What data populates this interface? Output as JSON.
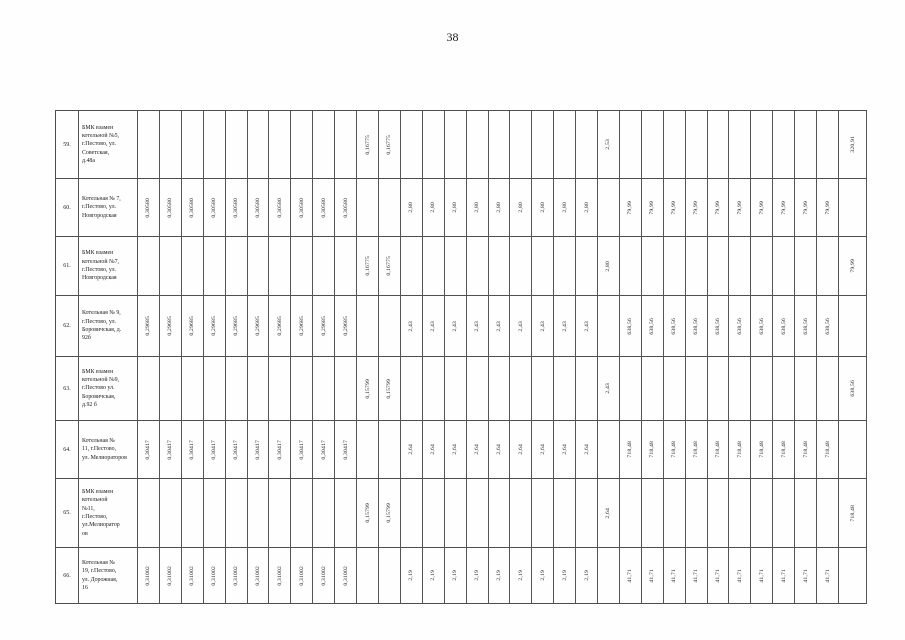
{
  "page": {
    "number": "38"
  },
  "table": {
    "num_data_columns": 33,
    "rows": [
      {
        "num": "59.",
        "name": "БМК взамен котельной №5, г.Пестово, ул. Советская, д.48а",
        "name_lines": [
          "БМК взамен",
          "котельной №5,",
          "г.Пестово, ул.",
          "Советская,",
          "д.48а"
        ],
        "values": [
          "",
          "",
          "",
          "",
          "",
          "",
          "",
          "",
          "",
          "",
          "0,16775",
          "0,16775",
          "",
          "",
          "",
          "",
          "",
          "",
          "",
          "",
          "",
          "2,53",
          "",
          "",
          "",
          "",
          "",
          "",
          "",
          "",
          "",
          "",
          "320,91"
        ]
      },
      {
        "num": "60.",
        "name": "Котельная № 7, г.Пестово, ул. Новгородская",
        "name_lines": [
          "Котельная № 7,",
          "г.Пестово, ул.",
          "Новгородская"
        ],
        "values": [
          "0,30580",
          "0,30580",
          "0,30580",
          "0,30580",
          "0,30580",
          "0,30580",
          "0,30580",
          "0,30580",
          "0,30580",
          "0,30580",
          "",
          "",
          "2,80",
          "2,80",
          "2,80",
          "2,80",
          "2,80",
          "2,80",
          "2,80",
          "2,80",
          "2,80",
          "",
          "79,99",
          "79,99",
          "79,99",
          "79,99",
          "79,99",
          "79,99",
          "79,99",
          "79,99",
          "79,99",
          "79,99",
          ""
        ]
      },
      {
        "num": "61.",
        "name": "БМК взамен котельной №7, г.Пестово, ул. Новгородская",
        "name_lines": [
          "БМК взамен",
          "котельной №7,",
          "г.Пестово, ул.",
          "Новгородская"
        ],
        "values": [
          "",
          "",
          "",
          "",
          "",
          "",
          "",
          "",
          "",
          "",
          "0,16775",
          "0,16775",
          "",
          "",
          "",
          "",
          "",
          "",
          "",
          "",
          "",
          "2,80",
          "",
          "",
          "",
          "",
          "",
          "",
          "",
          "",
          "",
          "",
          "79,99"
        ]
      },
      {
        "num": "62.",
        "name": "Котельная № 9, г.Пестово, ул. Боровичская, д. 92б",
        "name_lines": [
          "Котельная № 9,",
          "г.Пестово, ул.",
          "Боровичская, д.",
          "92б"
        ],
        "values": [
          "0,29685",
          "0,29685",
          "0,29685",
          "0,29685",
          "0,29685",
          "0,29685",
          "0,29685",
          "0,29685",
          "0,29685",
          "0,29685",
          "",
          "",
          "2,43",
          "2,43",
          "2,43",
          "2,43",
          "2,43",
          "2,43",
          "2,43",
          "2,43",
          "2,43",
          "",
          "638,56",
          "638,56",
          "638,56",
          "638,56",
          "638,56",
          "638,56",
          "638,56",
          "638,56",
          "638,56",
          "638,56",
          ""
        ]
      },
      {
        "num": "63.",
        "name": "БМК взамен котельной №9, г.Пестово ул. Боровичская, д.92 б",
        "name_lines": [
          "БМК взамен",
          "котельной №9,",
          "г.Пестово ул.",
          "Боровичская,",
          "д.92 б"
        ],
        "values": [
          "",
          "",
          "",
          "",
          "",
          "",
          "",
          "",
          "",
          "",
          "0,15799",
          "0,15799",
          "",
          "",
          "",
          "",
          "",
          "",
          "",
          "",
          "",
          "2,43",
          "",
          "",
          "",
          "",
          "",
          "",
          "",
          "",
          "",
          "",
          "638,56"
        ]
      },
      {
        "num": "64.",
        "name": "Котельная № 11, г.Пестово, ул. Мелиораторов",
        "name_lines": [
          "Котельная №",
          "11, г.Пестово,",
          "ул. Мелиораторов"
        ],
        "values": [
          "0,30417",
          "0,30417",
          "0,30417",
          "0,30417",
          "0,30417",
          "0,30417",
          "0,30417",
          "0,30417",
          "0,30417",
          "0,30417",
          "",
          "",
          "2,64",
          "2,64",
          "2,64",
          "2,64",
          "2,64",
          "2,64",
          "2,64",
          "2,64",
          "2,64",
          "",
          "718,48",
          "718,48",
          "718,48",
          "718,48",
          "718,48",
          "718,48",
          "718,48",
          "718,48",
          "718,48",
          "718,48",
          ""
        ]
      },
      {
        "num": "65.",
        "name": "БМК взамен котельной №11, г.Пестово, ул.Мелиораторов",
        "name_lines": [
          "БМК взамен",
          "котельной",
          "№11,",
          "г.Пестово,",
          "ул.Мелиоратор",
          "ов"
        ],
        "values": [
          "",
          "",
          "",
          "",
          "",
          "",
          "",
          "",
          "",
          "",
          "0,15799",
          "0,15799",
          "",
          "",
          "",
          "",
          "",
          "",
          "",
          "",
          "",
          "2,64",
          "",
          "",
          "",
          "",
          "",
          "",
          "",
          "",
          "",
          "",
          "718,48"
        ]
      },
      {
        "num": "66.",
        "name": "Котельная № 19, г.Пестово, ул. Дорожная, 16",
        "name_lines": [
          "Котельная №",
          "19, г.Пестово,",
          "ул. Дорожная,",
          "16"
        ],
        "values": [
          "0,31002",
          "0,31002",
          "0,31002",
          "0,31002",
          "0,31002",
          "0,31002",
          "0,31002",
          "0,31002",
          "0,31002",
          "0,31002",
          "",
          "",
          "2,19",
          "2,19",
          "2,19",
          "2,19",
          "2,19",
          "2,19",
          "2,19",
          "2,19",
          "2,19",
          "",
          "41,71",
          "41,71",
          "41,71",
          "41,71",
          "41,71",
          "41,71",
          "41,71",
          "41,71",
          "41,71",
          "41,71",
          ""
        ]
      }
    ]
  }
}
